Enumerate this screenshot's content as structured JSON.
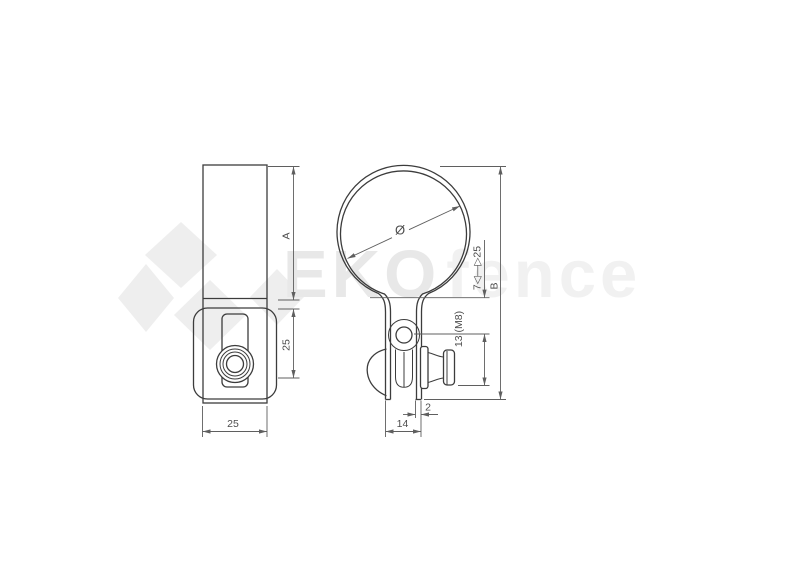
{
  "drawing": {
    "type": "technical drawing of a pipe clamp, two orthographic views"
  },
  "side_view": {
    "dim_height": "A",
    "dim_band_height": "25",
    "dim_width": "25"
  },
  "front_view": {
    "dim_diameter": "Ø",
    "dim_range": "7◁—▷25",
    "dim_overall_height": "B",
    "dim_bolt": "13 (M8)",
    "dim_leg_thickness": "2",
    "dim_leg_gap": "14"
  },
  "watermark": {
    "brand_bold": "EKO",
    "brand_light": "fence"
  },
  "colors": {
    "outline": "#3c3c3c",
    "dimension": "#5f5f5f",
    "label": "#4d4d4d",
    "watermark_logo": "#eeeeee",
    "watermark_text_bold": "#e8e8e8",
    "watermark_text_light": "#f1f1f1",
    "background": "#ffffff"
  }
}
